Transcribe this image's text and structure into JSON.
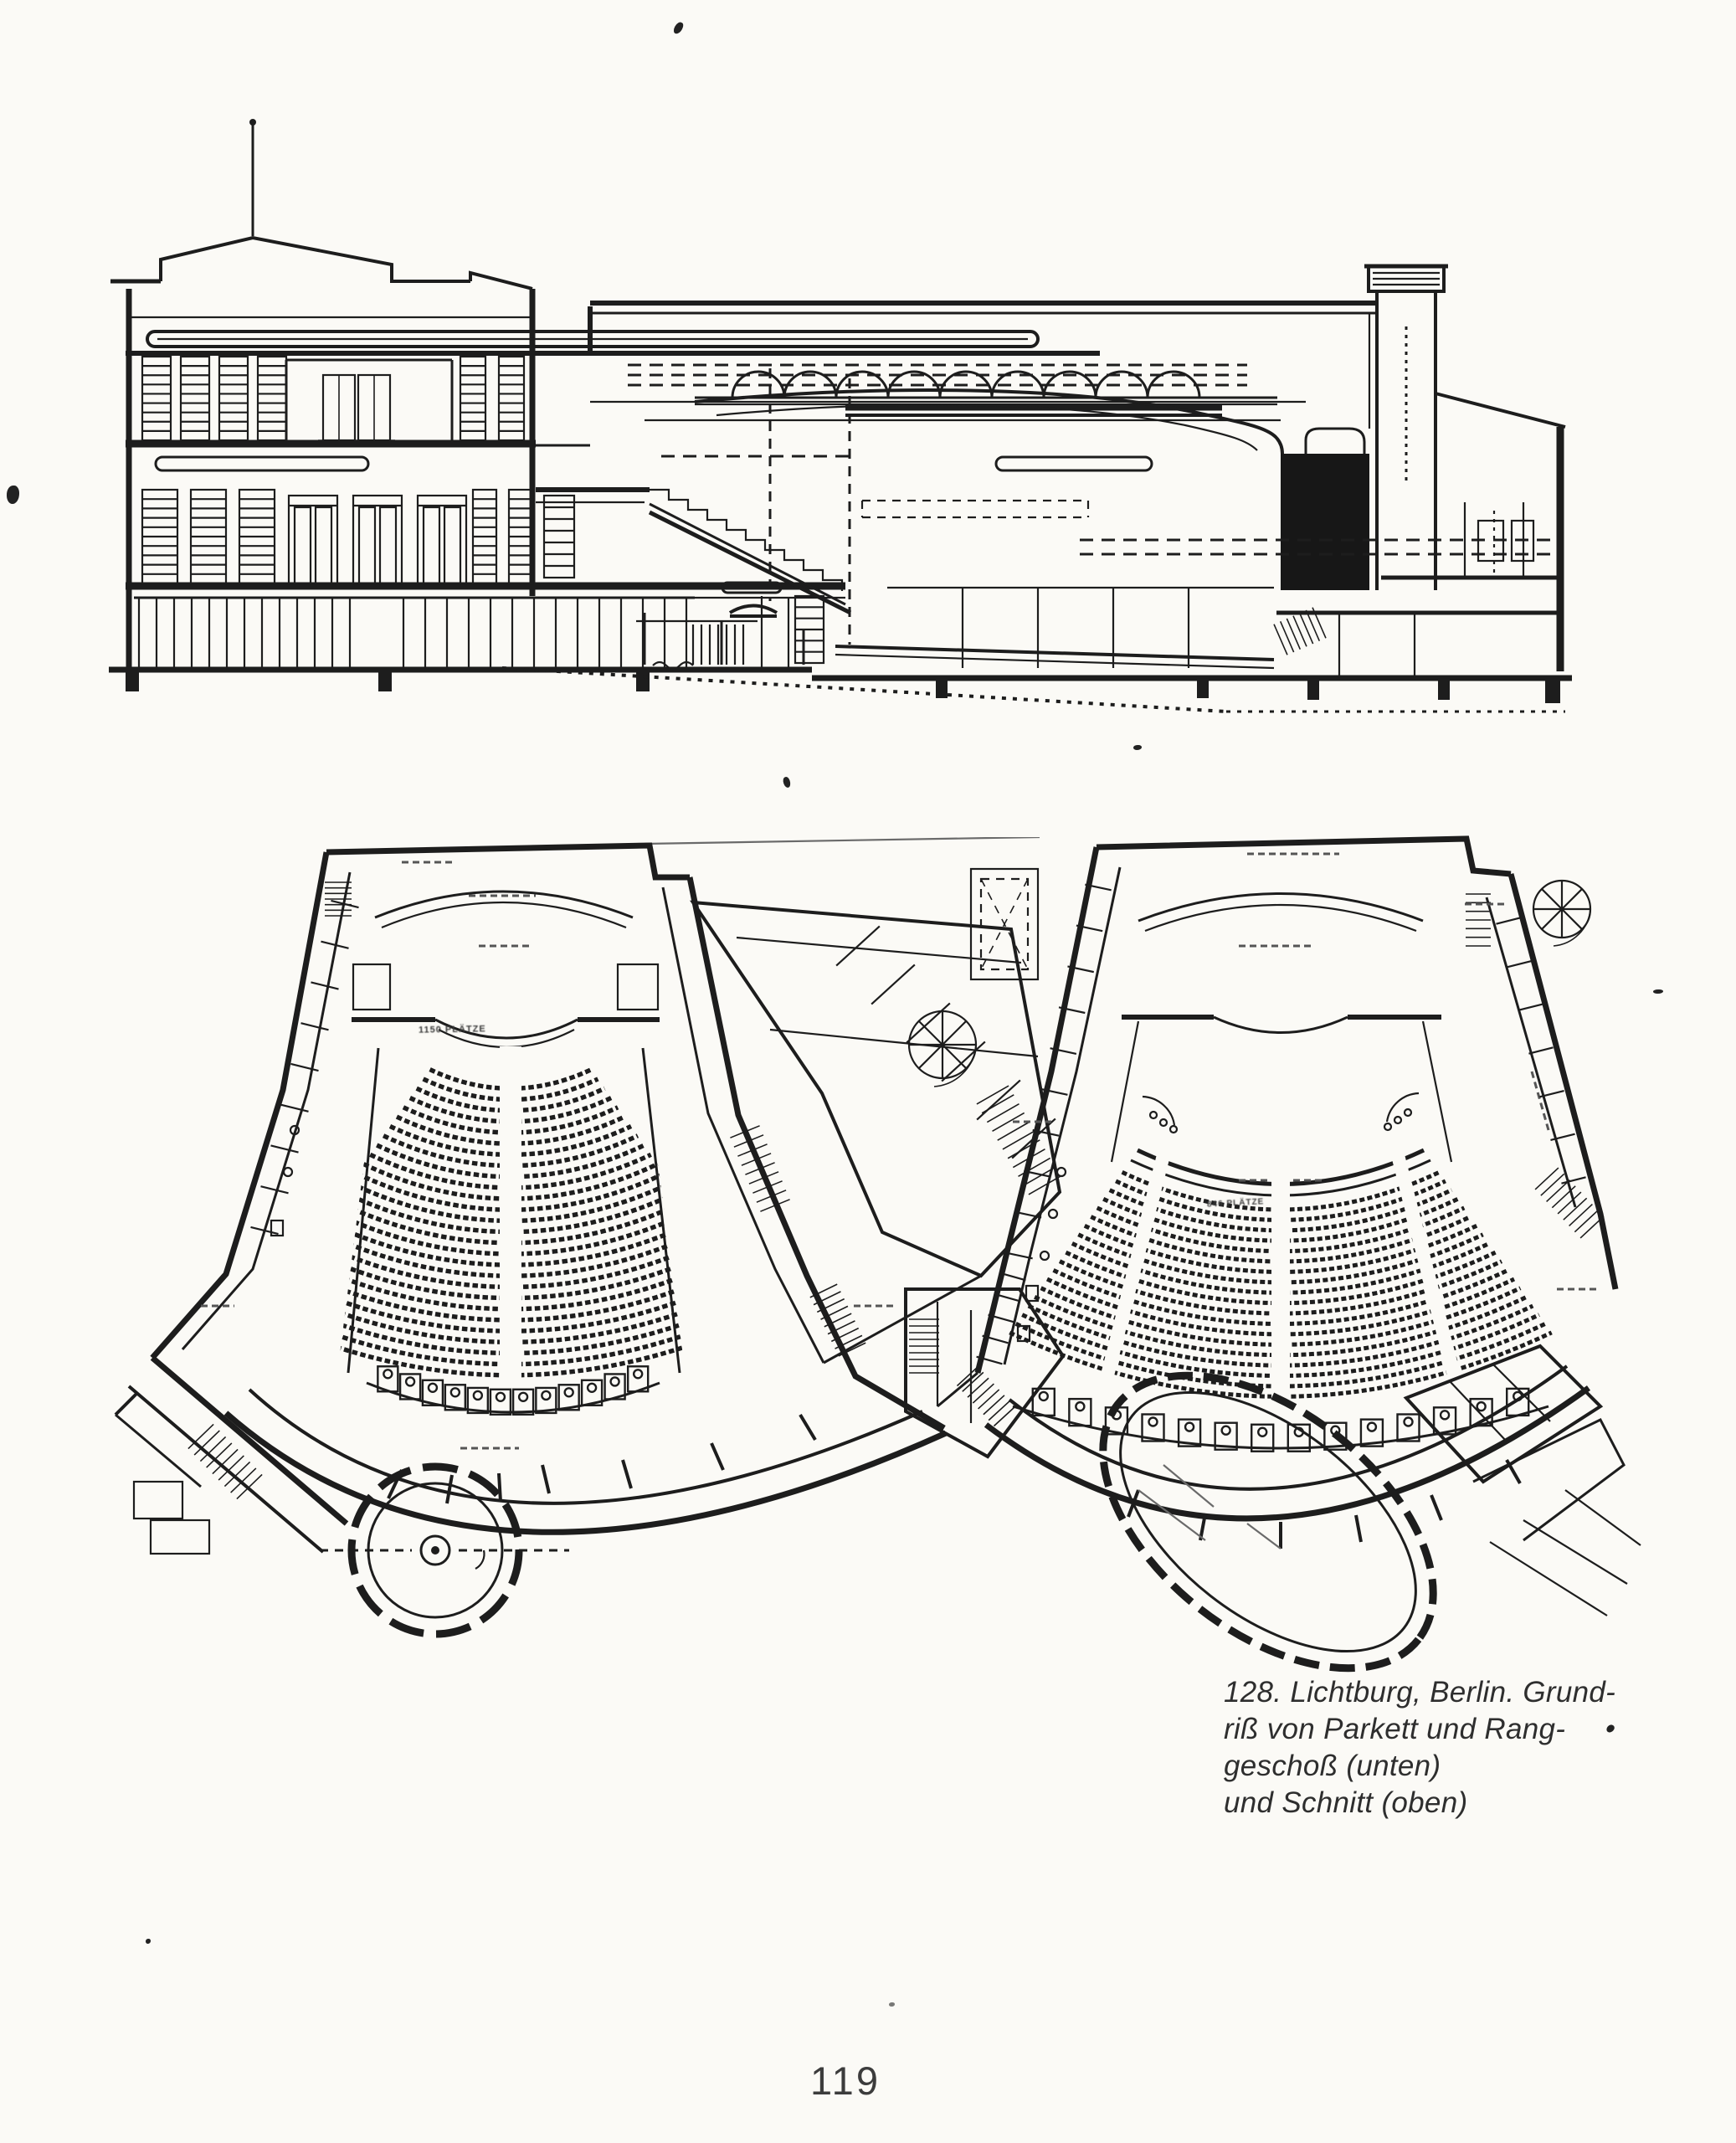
{
  "page": {
    "number": "119",
    "paper_color": "#fbfaf6",
    "ink_color": "#1d1d1d"
  },
  "caption": {
    "lines": [
      "128. Lichtburg, Berlin. Grund-",
      "riß von Parkett und Rang-",
      "geschoß (unten)",
      "und Schnitt (oben)"
    ]
  },
  "plans": {
    "parkett_seat_label": "1150 PLÄTZE",
    "rang_seat_label": "846 PLÄTZE"
  }
}
